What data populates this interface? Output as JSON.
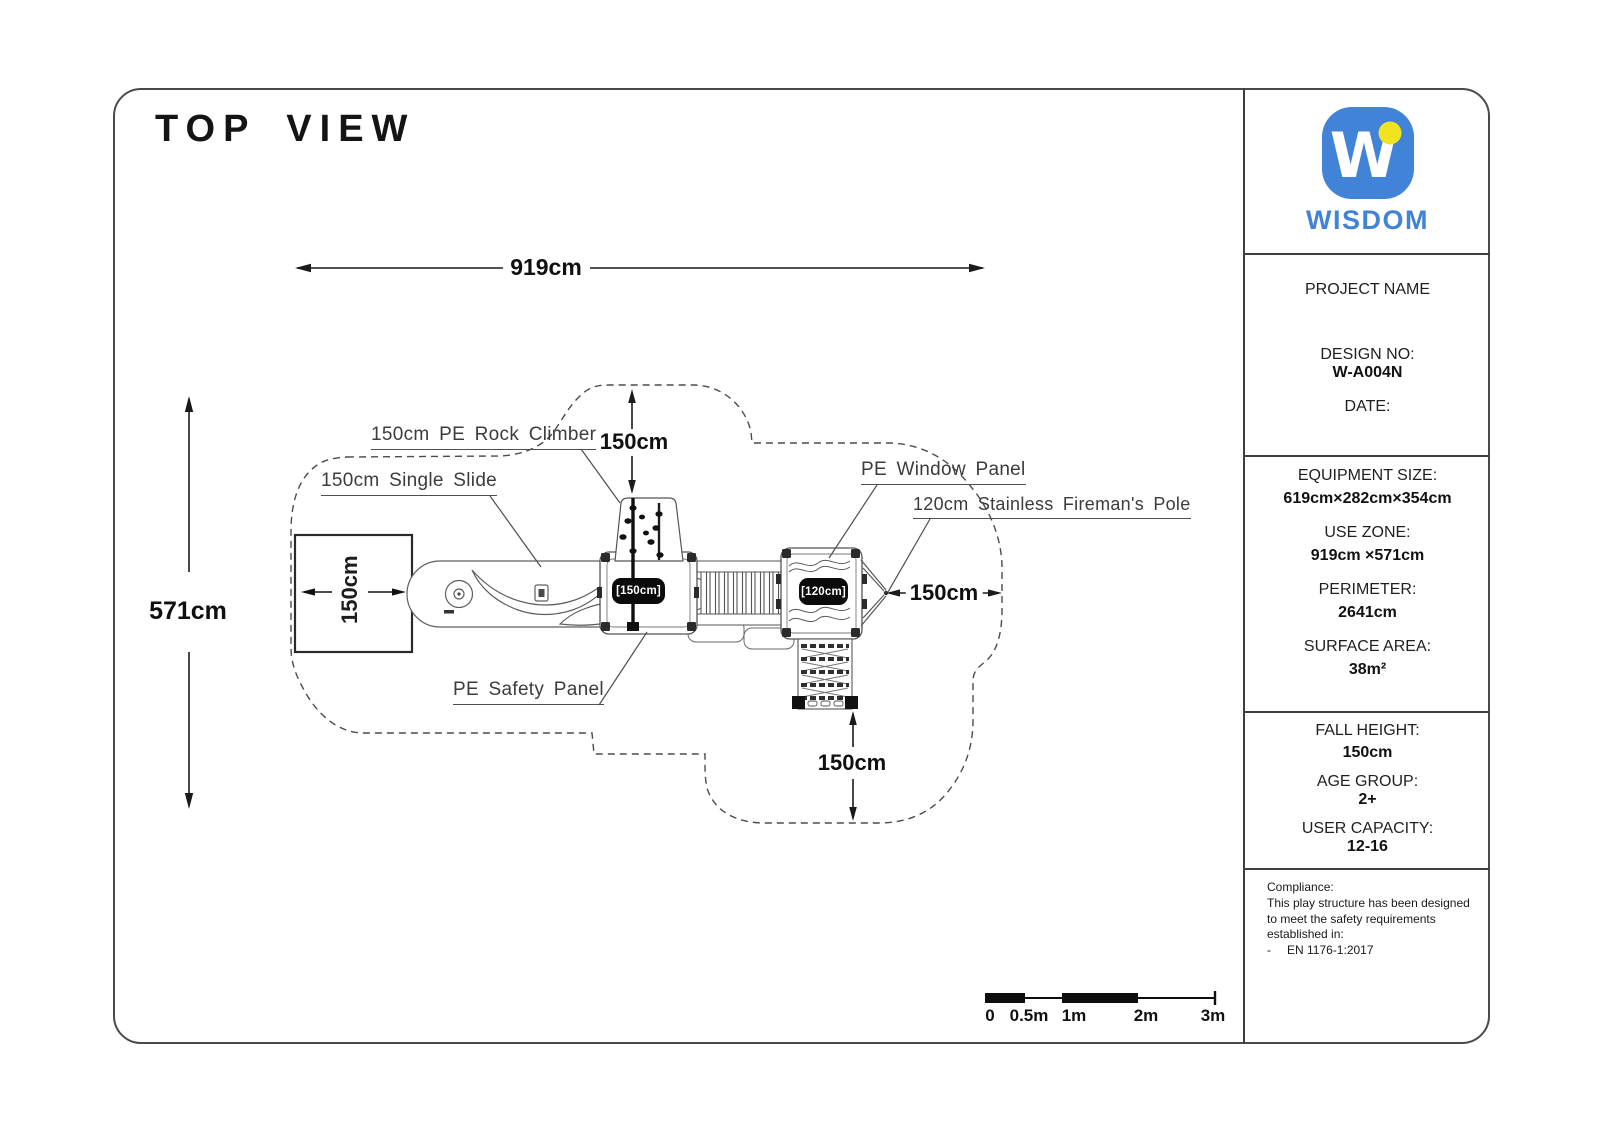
{
  "title": "TOP VIEW",
  "brand": {
    "logo_letter": "W",
    "name": "WISDOM",
    "blue": "#4183d7",
    "yellow": "#f2e322"
  },
  "sidebar": {
    "project": {
      "name_label": "PROJECT NAME",
      "design_label": "DESIGN NO:",
      "design_value": "W-A004N",
      "date_label": "DATE:"
    },
    "specs": {
      "equipment_size_label": "EQUIPMENT SIZE:",
      "equipment_size_value": "619cm×282cm×354cm",
      "use_zone_label": "USE ZONE:",
      "use_zone_value": "919cm ×571cm",
      "perimeter_label": "PERIMETER:",
      "perimeter_value": "2641cm",
      "surface_area_label": "SURFACE AREA:",
      "surface_area_value": "38m²"
    },
    "safety": {
      "fall_height_label": "FALL HEIGHT:",
      "fall_height_value": "150cm",
      "age_group_label": "AGE GROUP:",
      "age_group_value": "2+",
      "user_capacity_label": "USER CAPACITY:",
      "user_capacity_value": "12-16"
    },
    "compliance": {
      "heading": "Compliance:",
      "line1": "This play structure has been designed",
      "line2": "to meet the safety requirements",
      "line3": "established in:",
      "bullet": "-",
      "standard": "EN 1176-1:2017"
    }
  },
  "dimensions": {
    "overall_width": "919cm",
    "overall_depth": "571cm",
    "climber_clearance": "150cm",
    "pole_clearance": "150cm",
    "ladder_clearance": "150cm",
    "slide_exit": "150cm"
  },
  "labels": {
    "rock_climber": "150cm PE Rock Climber",
    "single_slide": "150cm Single Slide",
    "window_panel": "PE Window Panel",
    "fireman_pole": "120cm Stainless Fireman's Pole",
    "safety_panel": "PE Safety Panel"
  },
  "tags": {
    "main_platform": "[150cm]",
    "second_platform": "[120cm]"
  },
  "scale_bar": {
    "labels": [
      "0",
      "0.5m",
      "1m",
      "2m",
      "3m"
    ]
  }
}
